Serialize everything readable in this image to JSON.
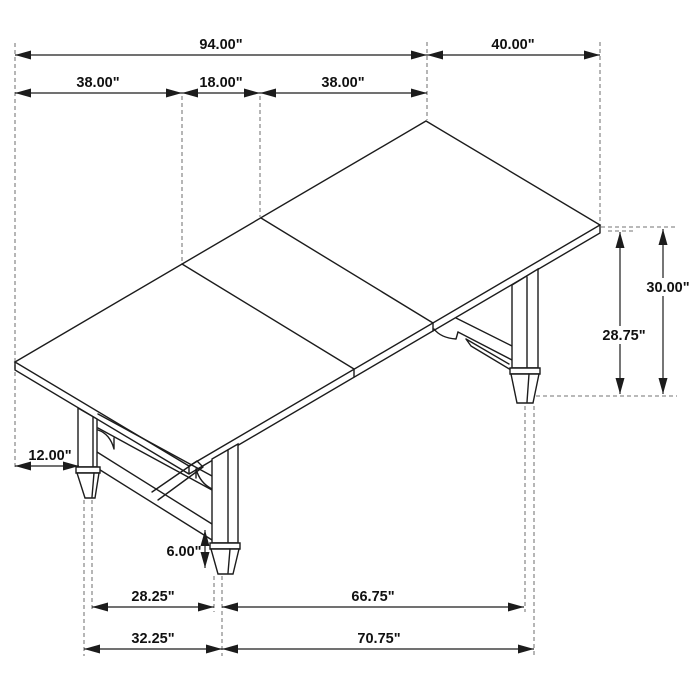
{
  "drawing": {
    "type": "isometric-dimension-drawing",
    "subject": "extendable trestle dining table with removable leaf",
    "unit": "inches",
    "colors": {
      "line": "#1c1c1c",
      "extension_line": "#8f8f8f",
      "text": "#111111",
      "background": "#ffffff"
    },
    "labels": {
      "table_length": "94.00\"",
      "table_depth": "40.00\"",
      "left_section": "38.00\"",
      "leaf_section": "18.00\"",
      "right_section": "38.00\"",
      "end_overhang": "12.00\"",
      "foot_height": "6.00\"",
      "apron_clearance_height": "28.75\"",
      "overall_height": "30.00\"",
      "leg_spacing_inner": "28.25\"",
      "leg_spacing_long_inner": "66.75\"",
      "leg_spacing_outer": "32.25\"",
      "leg_spacing_long_outer": "70.75\""
    }
  }
}
